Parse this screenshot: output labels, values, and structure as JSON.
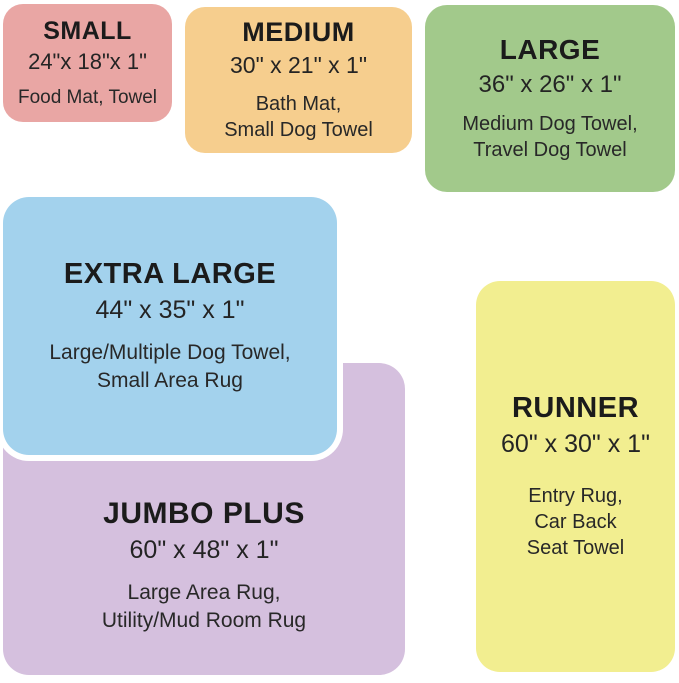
{
  "page": {
    "background_color": "#ffffff",
    "text_color": "#212121"
  },
  "sizes": [
    {
      "id": "small",
      "name": "SMALL",
      "dimensions": "24\"x 18\"x 1\"",
      "uses": [
        "Food Mat, Towel"
      ],
      "color": "#E9A6A4"
    },
    {
      "id": "medium",
      "name": "MEDIUM",
      "dimensions": "30\" x 21\" x 1\"",
      "uses": [
        "Bath Mat,",
        "Small Dog Towel"
      ],
      "color": "#F6CE8E"
    },
    {
      "id": "large",
      "name": "LARGE",
      "dimensions": "36\" x 26\" x 1\"",
      "uses": [
        "Medium Dog Towel,",
        "Travel Dog Towel"
      ],
      "color": "#A2C98B"
    },
    {
      "id": "extra-large",
      "name": "EXTRA LARGE",
      "dimensions": "44\" x 35\" x 1\"",
      "uses": [
        "Large/Multiple Dog Towel,",
        "Small Area Rug"
      ],
      "color": "#A3D2ED"
    },
    {
      "id": "jumbo-plus",
      "name": "JUMBO PLUS",
      "dimensions": "60\" x 48\" x 1\"",
      "uses": [
        "Large Area Rug,",
        "Utility/Mud Room Rug"
      ],
      "color": "#D5C0DE"
    },
    {
      "id": "runner",
      "name": "RUNNER",
      "dimensions": "60\" x 30\" x 1\"",
      "uses": [
        "Entry Rug,",
        "Car Back",
        "Seat Towel"
      ],
      "color": "#F2EE90"
    }
  ]
}
